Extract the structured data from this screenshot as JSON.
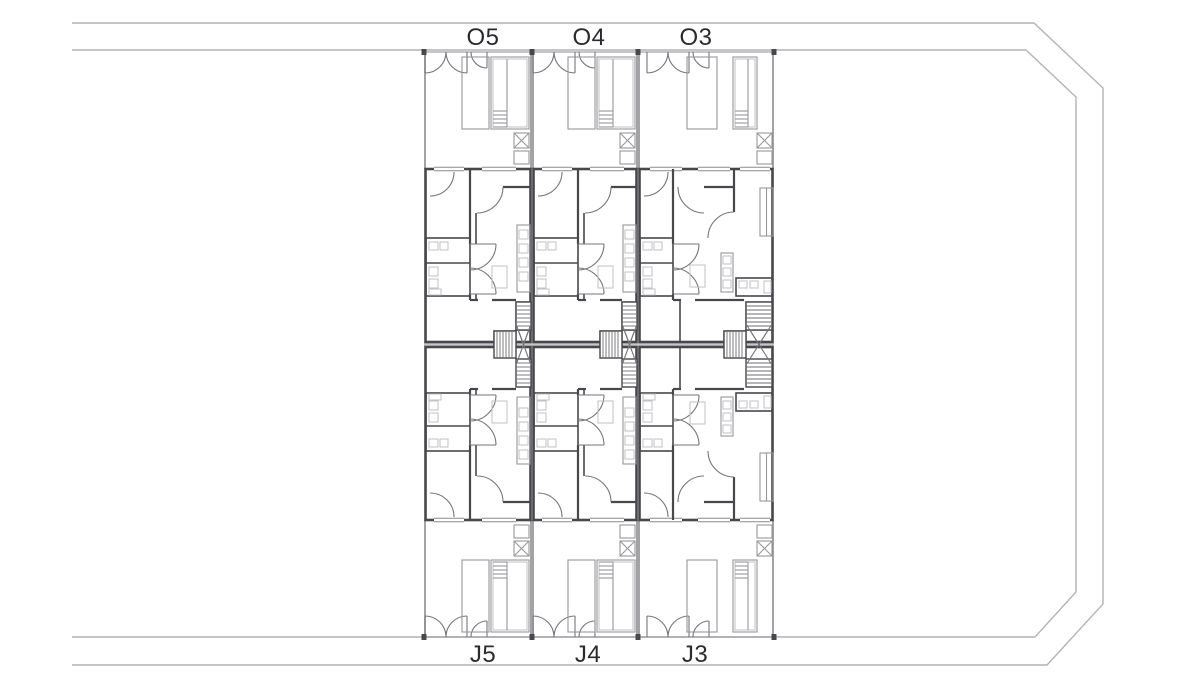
{
  "page": {
    "background": "#ffffff",
    "description": "Site floor plan of six terraced housing units with gardens, pools, stairs and road boundary"
  },
  "plan": {
    "type": "architectural-floor-plan",
    "units": [
      {
        "label": "O5",
        "row": "top",
        "position": "left"
      },
      {
        "label": "O4",
        "row": "top",
        "position": "middle"
      },
      {
        "label": "O3",
        "row": "top",
        "position": "right"
      },
      {
        "label": "J5",
        "row": "bottom",
        "position": "left"
      },
      {
        "label": "J4",
        "row": "bottom",
        "position": "middle"
      },
      {
        "label": "J3",
        "row": "bottom",
        "position": "right"
      }
    ],
    "colors": {
      "background": "#ffffff",
      "road_line": "#b4b4b8",
      "wall_dark": "#48484c",
      "wall_medium": "#8c8c90",
      "fixture_light": "#c2c2c6",
      "arc_line": "#76767a",
      "stair_tread": "#6e6e72",
      "party_band": "#c6c6ca",
      "label_text": "#2b2b2f"
    }
  }
}
